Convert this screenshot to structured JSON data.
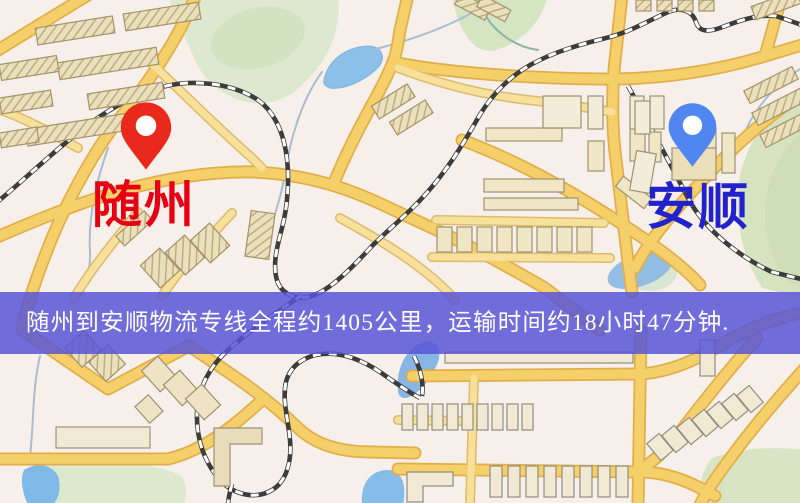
{
  "map": {
    "kind": "static-route-map",
    "markers": [
      {
        "id": "suizhou",
        "label": "随州",
        "icon": "location-pin-icon",
        "pin_color": "#e8291c",
        "label_color": "#e60012"
      },
      {
        "id": "anshun",
        "label": "安顺",
        "icon": "location-pin-icon",
        "pin_color": "#4f86f0",
        "label_color": "#2222cc"
      }
    ],
    "palette": {
      "background": "#f7f0ea",
      "road_yellow": "#f5d06a",
      "road_casing": "#e2ae4a",
      "minor_road": "#f7ebc5",
      "building_tan": "#eae0bd",
      "railway_dark": "#3c3c3c",
      "park_green": "#dde9cf",
      "water_blue": "#8cc0e8"
    }
  },
  "banner": {
    "text": "随州到安顺物流专线全程约1405公里，运输时间约18小时47分钟.",
    "bg_color": "#5654d6",
    "text_color": "#ffffff"
  }
}
